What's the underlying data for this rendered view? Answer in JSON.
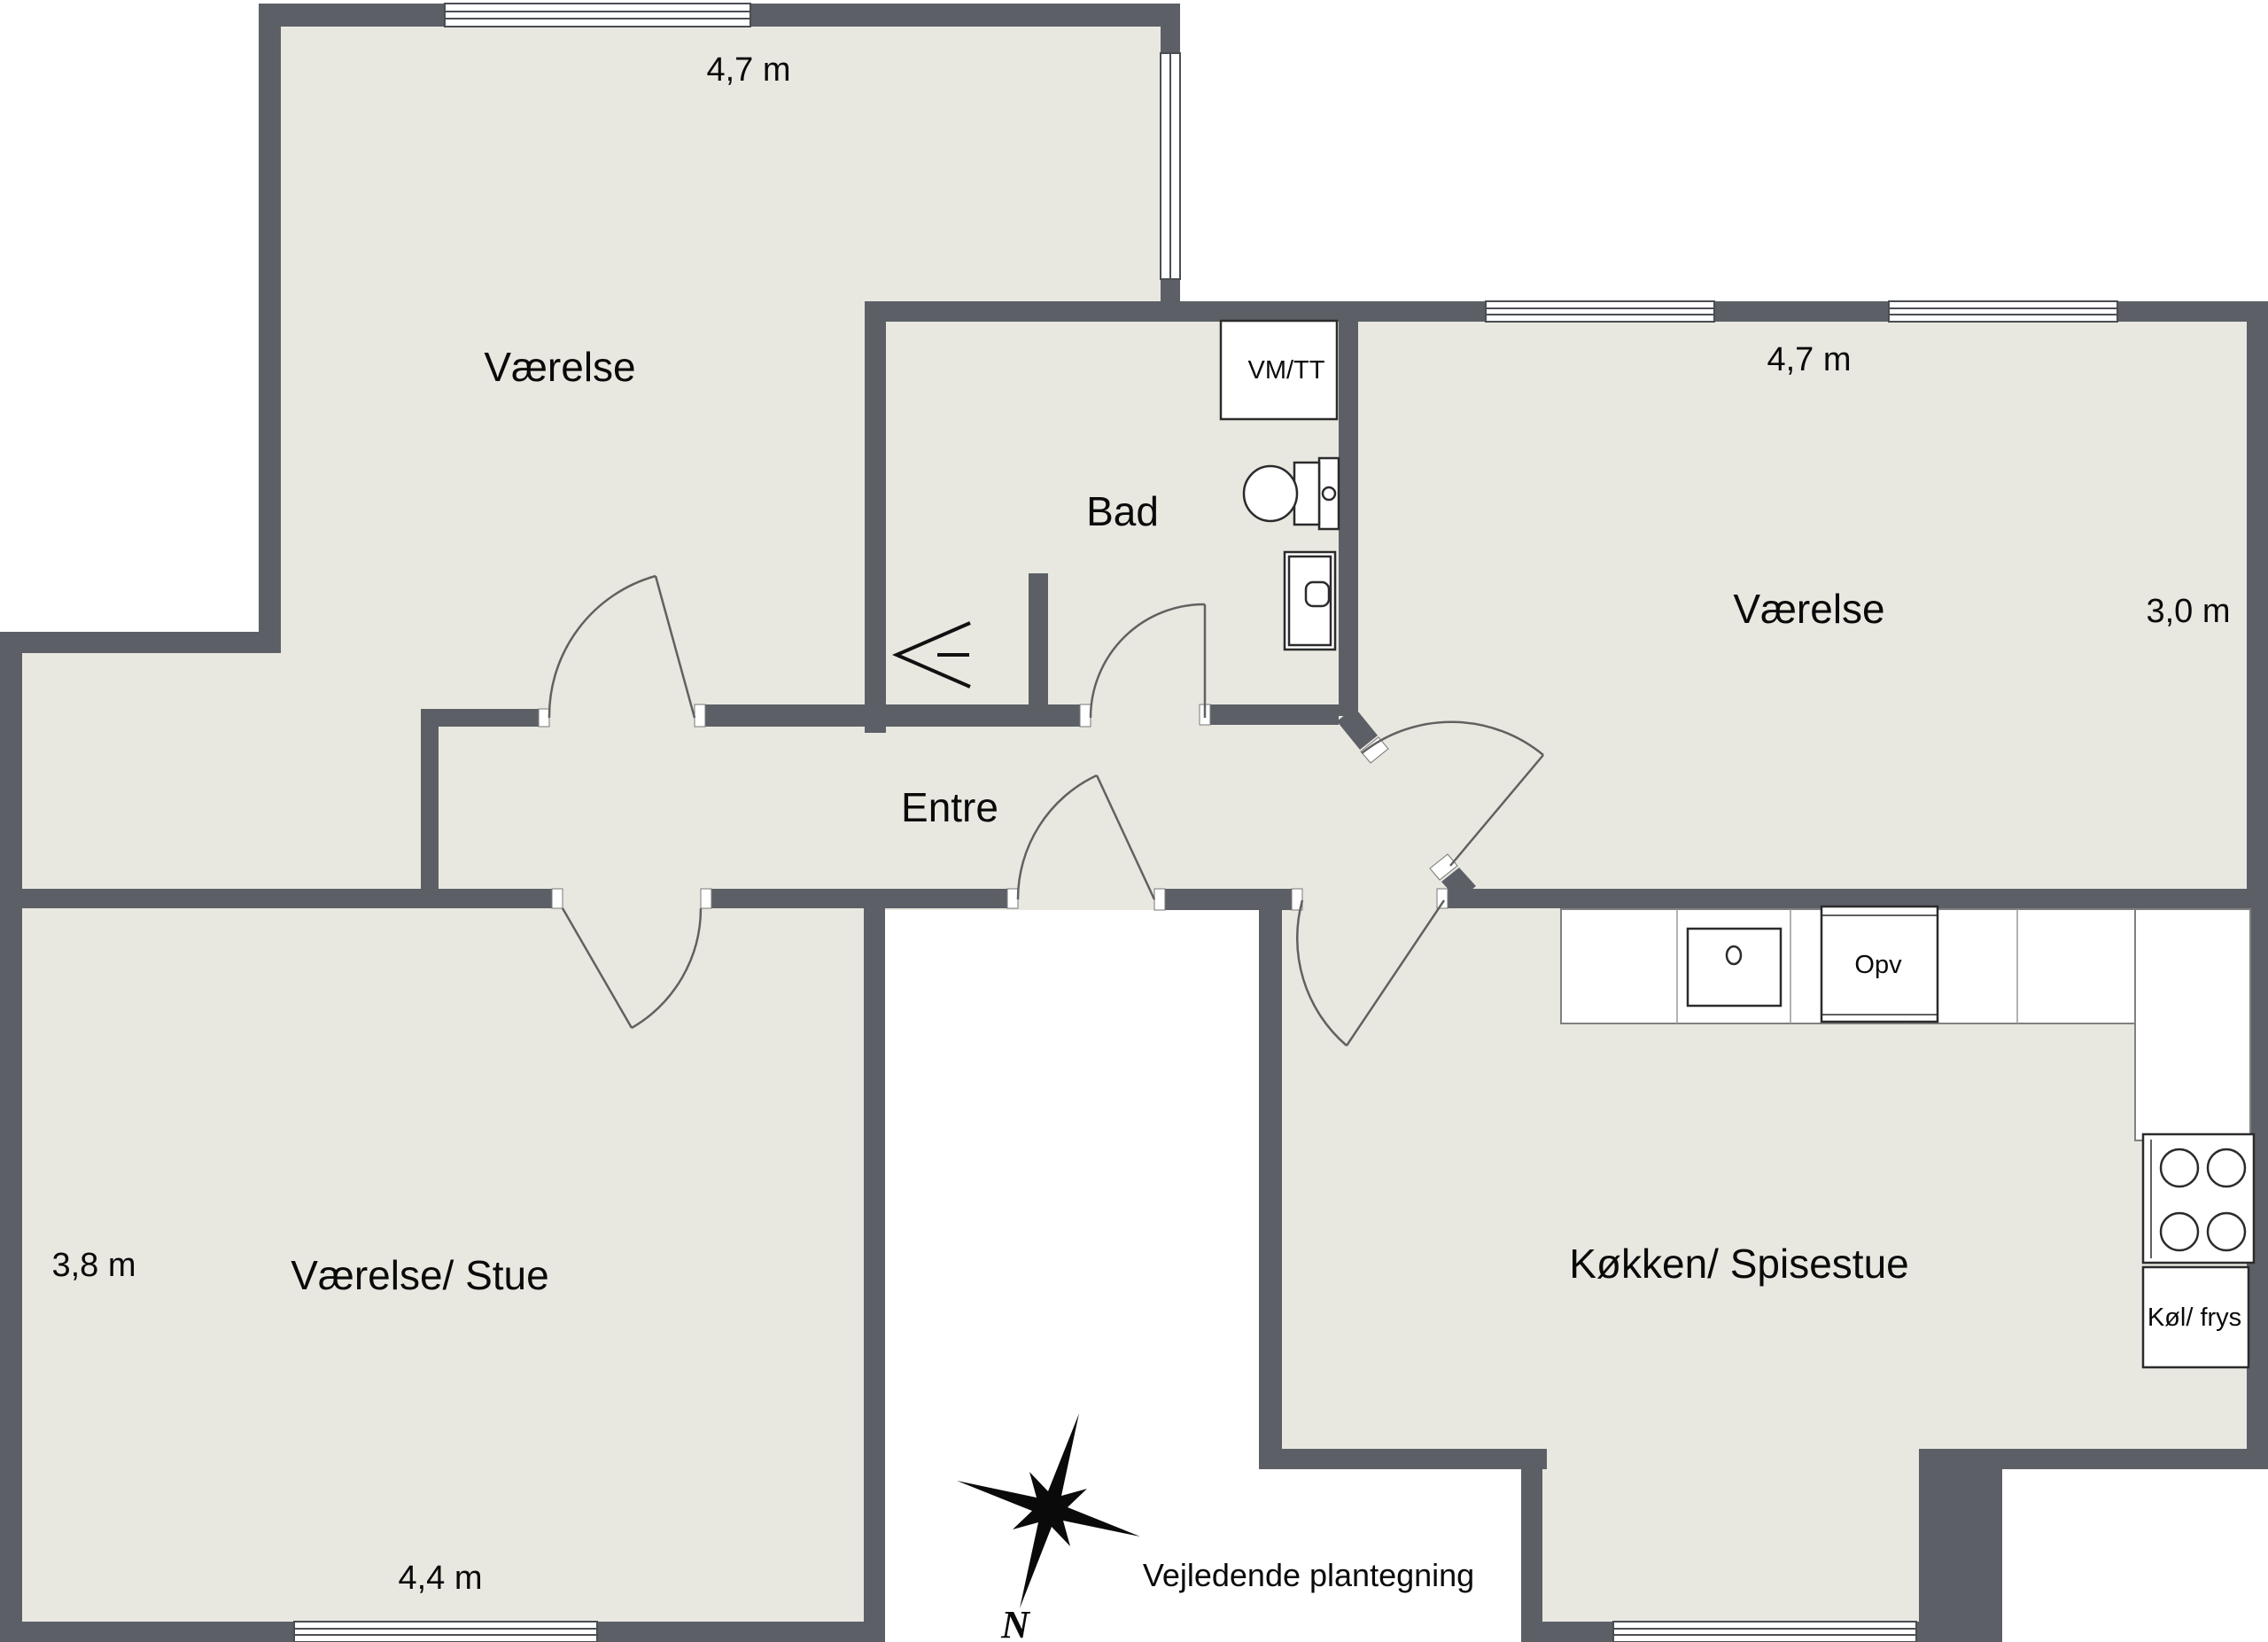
{
  "plan": {
    "title_note": "Vejledende plantegning",
    "compass": {
      "north_label": "N"
    },
    "colors": {
      "wall": "#5C6066",
      "floor": "#E9E8E0",
      "outside": "#FFFFFF"
    },
    "rooms": {
      "nw": {
        "label": "Værelse",
        "width_dim": "4,7 m"
      },
      "bath": {
        "label": "Bad"
      },
      "ne": {
        "label": "Værelse",
        "width_dim": "4,7 m",
        "depth_dim": "3,0 m"
      },
      "entre": {
        "label": "Entre"
      },
      "stue": {
        "label": "Værelse/ Stue",
        "depth_dim": "3,8 m",
        "width_dim": "4,4 m"
      },
      "kitchen": {
        "label": "Køkken/ Spisestue"
      }
    },
    "appliances": {
      "washer_dryer": "VM/TT",
      "dishwasher": "Opv",
      "fridge_freezer": "Køl/ frys"
    }
  }
}
